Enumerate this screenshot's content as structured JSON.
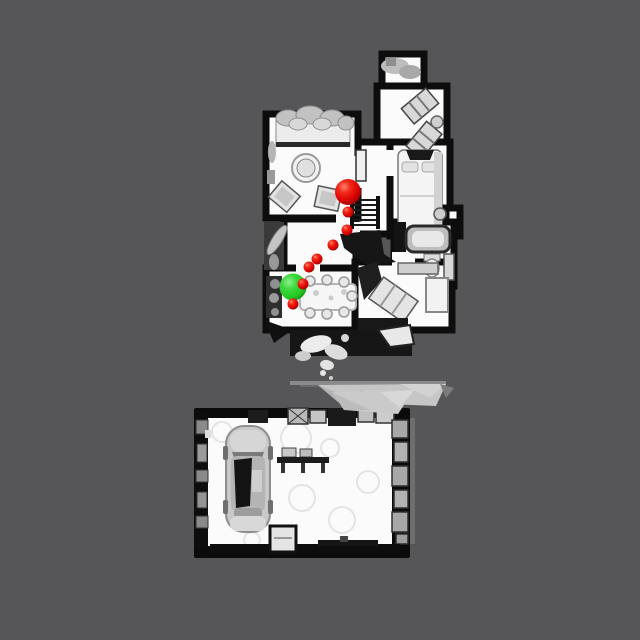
{
  "app": {
    "name": "top-down-scene-view",
    "description": "Top-down orthographic render of a 3D-scanned house and detached garage with a navigation path overlay"
  },
  "scene": {
    "background_color": "#565659",
    "palette": {
      "floor": "#fbfbfb",
      "walls": "#0d0d0d",
      "furniture_light": "#d9d9d9",
      "furniture_mid": "#b5b5b5",
      "terrain_gray": "#c6c6c6"
    },
    "regions": {
      "house": {
        "label": "house floor plan",
        "bounds": [
          264,
          50,
          458,
          340
        ]
      },
      "garage": {
        "label": "garage",
        "bounds": [
          192,
          388,
          414,
          560
        ]
      },
      "car": {
        "label": "car parked in garage",
        "bounds": [
          224,
          424,
          272,
          534
        ]
      }
    }
  },
  "navigation": {
    "start_marker": {
      "shape": "sphere",
      "color_hex": "#dc0404",
      "x": 348,
      "y": 192,
      "r": 13
    },
    "path_waypoints": {
      "shape": "sphere",
      "color_hex": "#dc0404",
      "r": 5.5,
      "points": [
        [
          348,
          212
        ],
        [
          347,
          230
        ],
        [
          333,
          245
        ],
        [
          317,
          259
        ],
        [
          309,
          267
        ],
        [
          303,
          284
        ],
        [
          293,
          304
        ]
      ]
    },
    "goal_marker": {
      "shape": "sphere",
      "color_hex": "#26c826",
      "x": 293,
      "y": 287,
      "r": 13.5
    },
    "marker_counts": {
      "red": 8,
      "green": 1
    }
  }
}
